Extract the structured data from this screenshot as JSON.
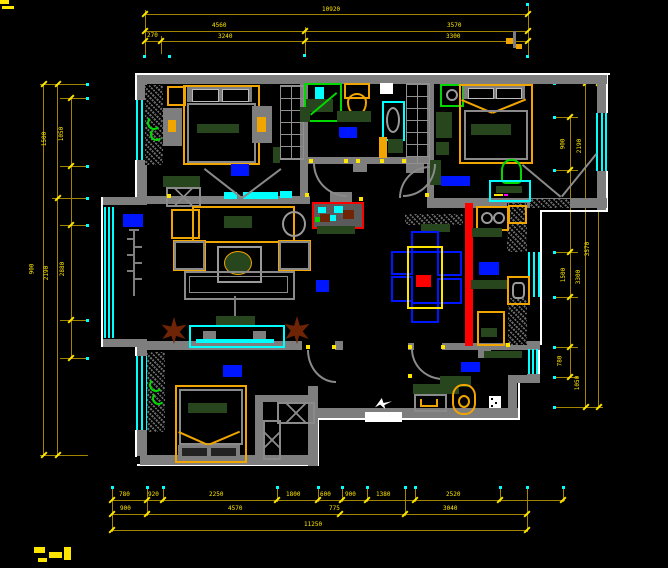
{
  "drawing": {
    "type": "apartment floor plan (CAD, dark theme)",
    "colors": {
      "background": "#000000",
      "wall": "#7e7e7e",
      "exterior_trim": "#ffffff",
      "window_glass": "#00ffff",
      "dimension_line": "#a38400",
      "dimension_text": "#ffe600",
      "furniture_accent_orange": "#f0a500",
      "furniture_dark_green": "#27461e",
      "decor_bright_green": "#00d900",
      "room_label_block": "#0016ff",
      "revision_line_red": "#ff0000",
      "plant_brown": "#6e2405"
    },
    "rooms": [
      {
        "id": "bedroom-master",
        "features": [
          "bed",
          "wardrobe",
          "dresser",
          "nightstands",
          "sliding-door",
          "label-block"
        ]
      },
      {
        "id": "bathroom",
        "features": [
          "shower",
          "toilet",
          "vanity",
          "sink",
          "shelf-cabinet",
          "label-block"
        ]
      },
      {
        "id": "bedroom-2",
        "features": [
          "bed",
          "desk",
          "chair",
          "ceiling-fan",
          "label-block"
        ]
      },
      {
        "id": "living-room",
        "features": [
          "sofa-set",
          "coffee-table",
          "tv-cabinet",
          "plants",
          "coat-rack",
          "label-block"
        ]
      },
      {
        "id": "dining-room",
        "features": [
          "table",
          "six-chairs",
          "sideboard"
        ]
      },
      {
        "id": "kitchen",
        "features": [
          "stove",
          "sink",
          "counters",
          "fridge",
          "label-block"
        ]
      },
      {
        "id": "bedroom-3",
        "features": [
          "bed",
          "wardrobe",
          "label-block"
        ]
      },
      {
        "id": "study",
        "features": [
          "desk",
          "chair",
          "side-table",
          "label-block"
        ]
      }
    ],
    "symbols": [
      "door-swing-arcs",
      "north-arrow",
      "elevation-marker",
      "hinge-dots",
      "witness-line-dots"
    ]
  },
  "dims": {
    "top": {
      "row1": [
        "10920"
      ],
      "row2": [
        "4560",
        "3570"
      ],
      "row3": [
        "270",
        "3240",
        "3300"
      ]
    },
    "bottom": {
      "rowA": [
        "780",
        "920",
        "2250",
        "1800",
        "600",
        "900",
        "1380",
        "2520"
      ],
      "rowB": [
        "900",
        "4570",
        "775",
        "3040"
      ],
      "rowC": [
        "11250"
      ]
    },
    "left": {
      "labels": [
        "1500",
        "1050",
        "900",
        "2190",
        "2880"
      ]
    },
    "right": {
      "labels": [
        "900",
        "2190",
        "3570",
        "1500",
        "3300",
        "780",
        "1050"
      ]
    }
  }
}
